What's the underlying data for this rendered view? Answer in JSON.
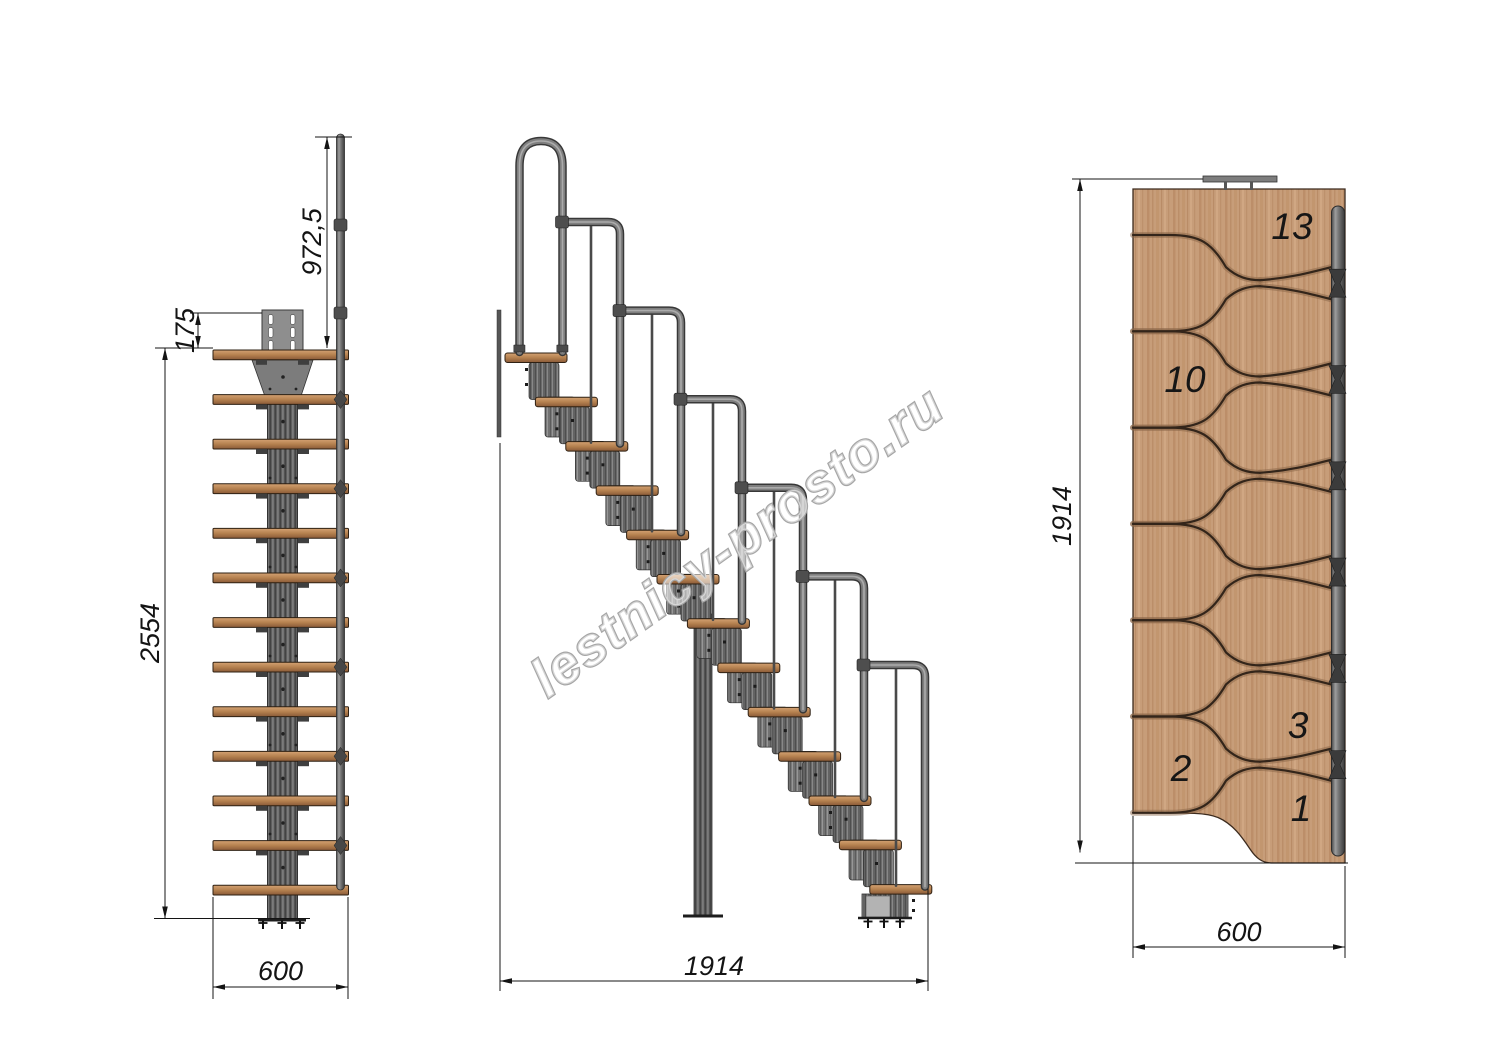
{
  "watermark": {
    "text": "lestnicy-prosto.ru"
  },
  "front_view": {
    "dim_handrail_height": "972,5",
    "dim_bracket_offset": "175",
    "dim_total_height": "2554",
    "dim_width": "600"
  },
  "side_view": {
    "dim_length": "1914"
  },
  "plan_view": {
    "dim_length": "1914",
    "dim_width": "600",
    "tread_labels": {
      "t13": "13",
      "t10": "10",
      "t3": "3",
      "t2": "2",
      "t1": "1"
    }
  },
  "colors": {
    "wood": "#c79d79",
    "wood_edge": "#b5814f",
    "metal": "#6a6a6a",
    "metal_dark": "#3c3c3c",
    "dimension": "#141414",
    "watermark": "#a6a6a6"
  }
}
